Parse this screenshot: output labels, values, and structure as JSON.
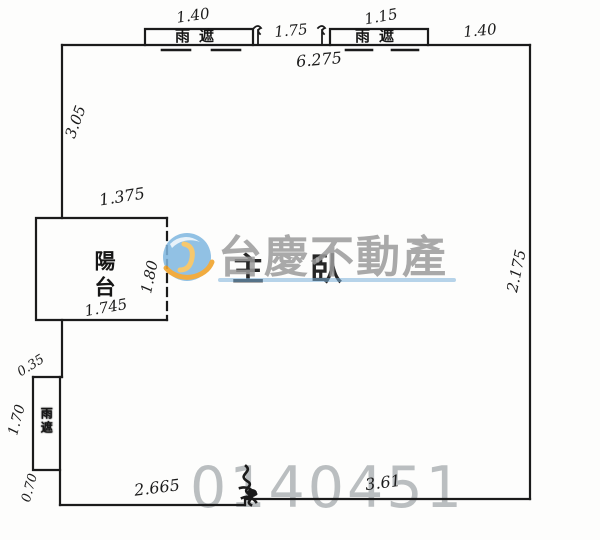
{
  "floor_plan": {
    "labels": {
      "rain_shelter": "雨遮",
      "balcony": "陽台",
      "room": "主臥"
    },
    "dimensions": {
      "top_shelter_left_width": "1.40",
      "top_middle_span": "1.75",
      "top_shelter_right_width": "1.15",
      "top_right_span": "1.40",
      "top_total": "6.275",
      "left_upper_height": "3.05",
      "balcony_top_width": "1.375",
      "balcony_right_depth": "1.80",
      "balcony_bottom_width": "1.745",
      "left_jog_depth": "0.35",
      "left_shelter_height": "1.70",
      "left_lower_height": "0.70",
      "bottom_left_span": "2.665",
      "bottom_right_span": "3.61",
      "right_side_height": "2.175"
    },
    "watermark": {
      "brand": "台慶不動產",
      "serial": "0140451",
      "colors": {
        "brand_text": "#9b9b9b",
        "serial_text": "#b7bbbd",
        "logo_sphere": "#7fb7e0",
        "logo_swirl": "#f0a42c",
        "underline": "#7cb0d8"
      }
    },
    "ink_color": "#1b1b1b"
  }
}
